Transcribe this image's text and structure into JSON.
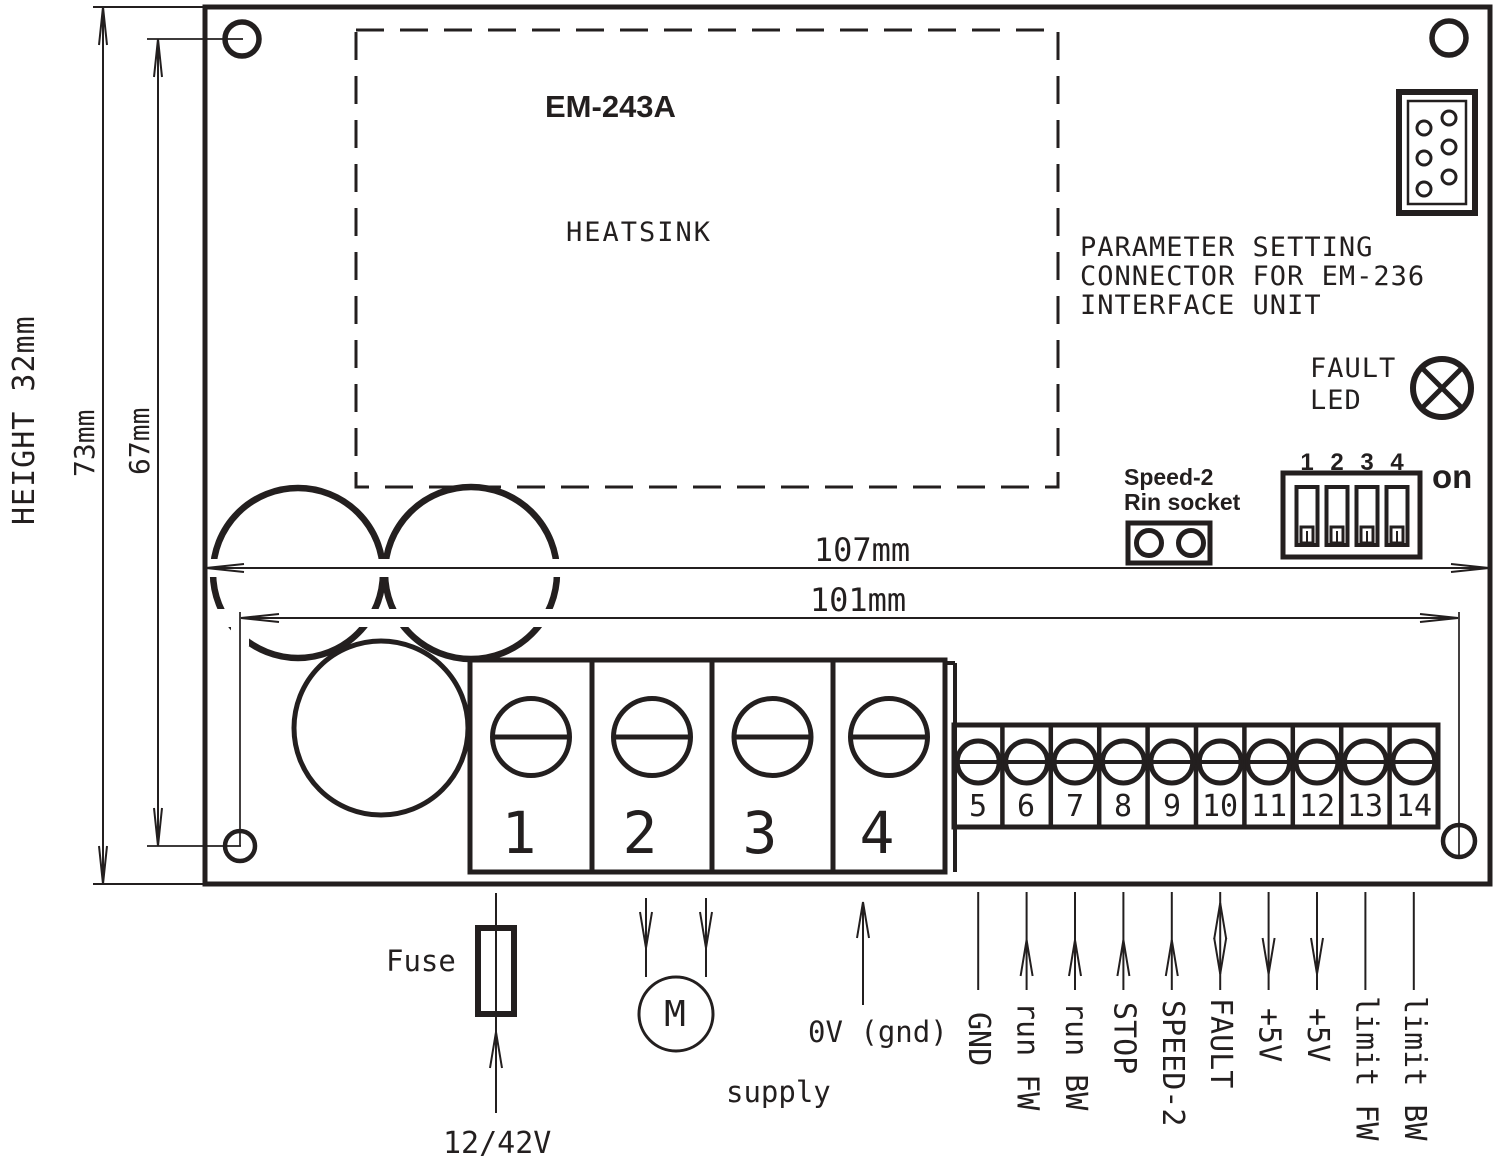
{
  "colors": {
    "ink": "#231f1f",
    "paper": "#ffffff"
  },
  "board": {
    "model": "EM-243A",
    "heatsink_label": "HEATSINK"
  },
  "dimensions": {
    "height_note": "HEIGHT 32mm",
    "outer_height": "73mm",
    "hole_height": "67mm",
    "outer_width": "107mm",
    "hole_width": "101mm"
  },
  "annotations": {
    "param_connector": [
      "PARAMETER SETTING",
      "CONNECTOR FOR EM-236",
      "INTERFACE UNIT"
    ],
    "fault_led": [
      "FAULT",
      "LED"
    ],
    "speed2_socket": [
      "Speed-2",
      "Rin socket"
    ]
  },
  "dip_switch": {
    "positions": [
      "1",
      "2",
      "3",
      "4"
    ],
    "on_label": "on"
  },
  "power_terminals": [
    "1",
    "2",
    "3",
    "4"
  ],
  "signal_terminals": [
    {
      "num": "5",
      "label": "GND",
      "arrow": "none"
    },
    {
      "num": "6",
      "label": "run FW",
      "arrow": "up"
    },
    {
      "num": "7",
      "label": "run BW",
      "arrow": "up"
    },
    {
      "num": "8",
      "label": "STOP",
      "arrow": "up"
    },
    {
      "num": "9",
      "label": "SPEED-2",
      "arrow": "up"
    },
    {
      "num": "10",
      "label": "FAULT",
      "arrow": "both"
    },
    {
      "num": "11",
      "label": "+5V",
      "arrow": "down"
    },
    {
      "num": "12",
      "label": "+5V",
      "arrow": "down"
    },
    {
      "num": "13",
      "label": "limit FW",
      "arrow": "none"
    },
    {
      "num": "14",
      "label": "limit BW",
      "arrow": "none"
    }
  ],
  "bottom": {
    "fuse_label": "Fuse",
    "voltage_label": "12/42V",
    "motor_label": "M",
    "gnd_label": "0V (gnd)",
    "supply_label": "supply"
  }
}
